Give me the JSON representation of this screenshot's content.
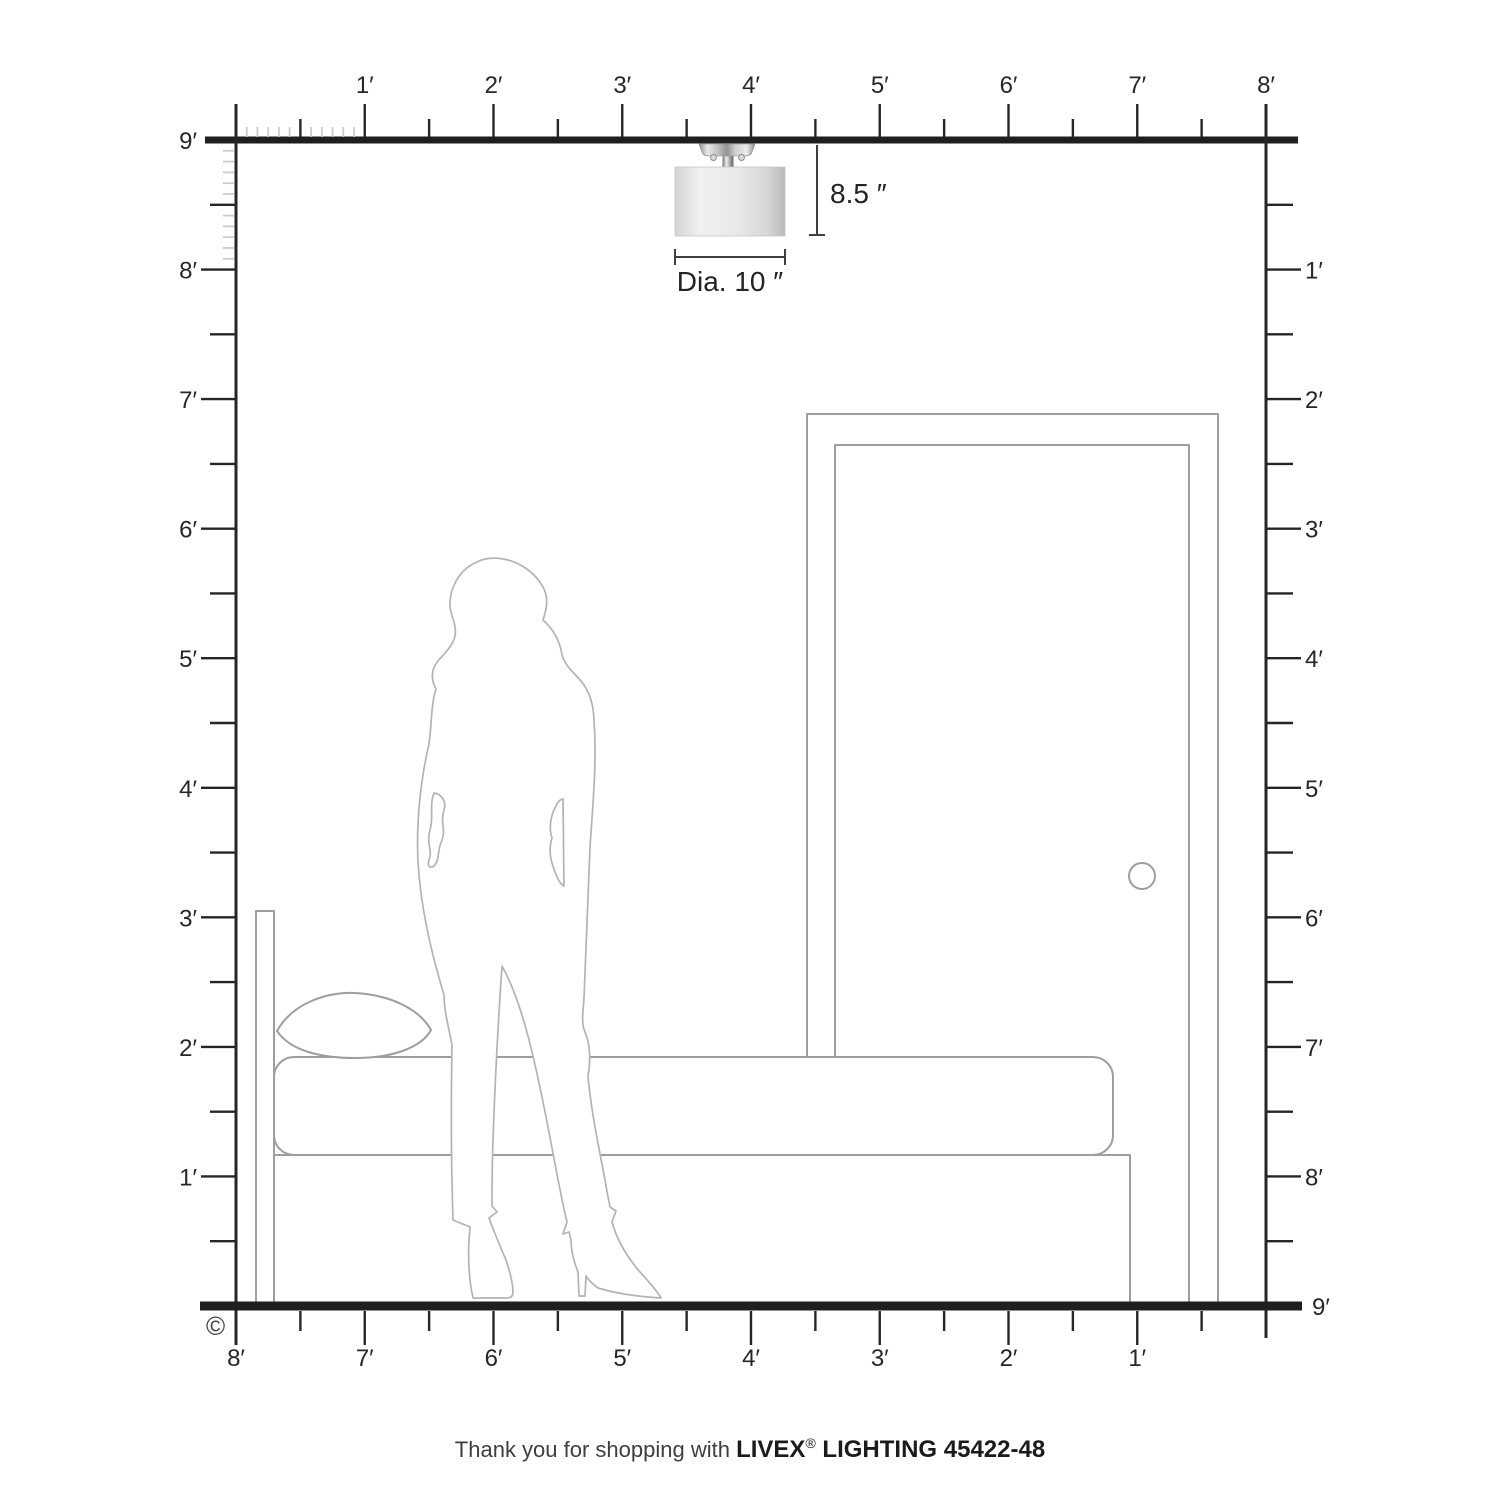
{
  "diagram": {
    "copyright_symbol": "©",
    "fixture": {
      "height_label": "8.5 ″",
      "diameter_label": "Dia. 10 ″"
    },
    "rulers": {
      "top_labels": [
        "1′",
        "2′",
        "3′",
        "4′",
        "5′",
        "6′",
        "7′",
        "8′"
      ],
      "left_labels": [
        "9′",
        "8′",
        "7′",
        "6′",
        "5′",
        "4′",
        "3′",
        "2′",
        "1′"
      ],
      "right_labels": [
        "1′",
        "2′",
        "3′",
        "4′",
        "5′",
        "6′",
        "7′",
        "8′",
        "9′"
      ],
      "bottom_labels": [
        "8′",
        "7′",
        "6′",
        "5′",
        "4′",
        "3′",
        "2′",
        "1′"
      ]
    },
    "footer": {
      "prefix": "Thank you for shopping with ",
      "brand": "LIVEX",
      "registered_mark": "®",
      "suffix": " LIGHTING 45422-48"
    },
    "colors": {
      "ink": "#262626",
      "furniture_outline": "#9e9e9e",
      "silhouette_outline": "#b3b3b3",
      "faint_tick": "#cccccc"
    }
  }
}
